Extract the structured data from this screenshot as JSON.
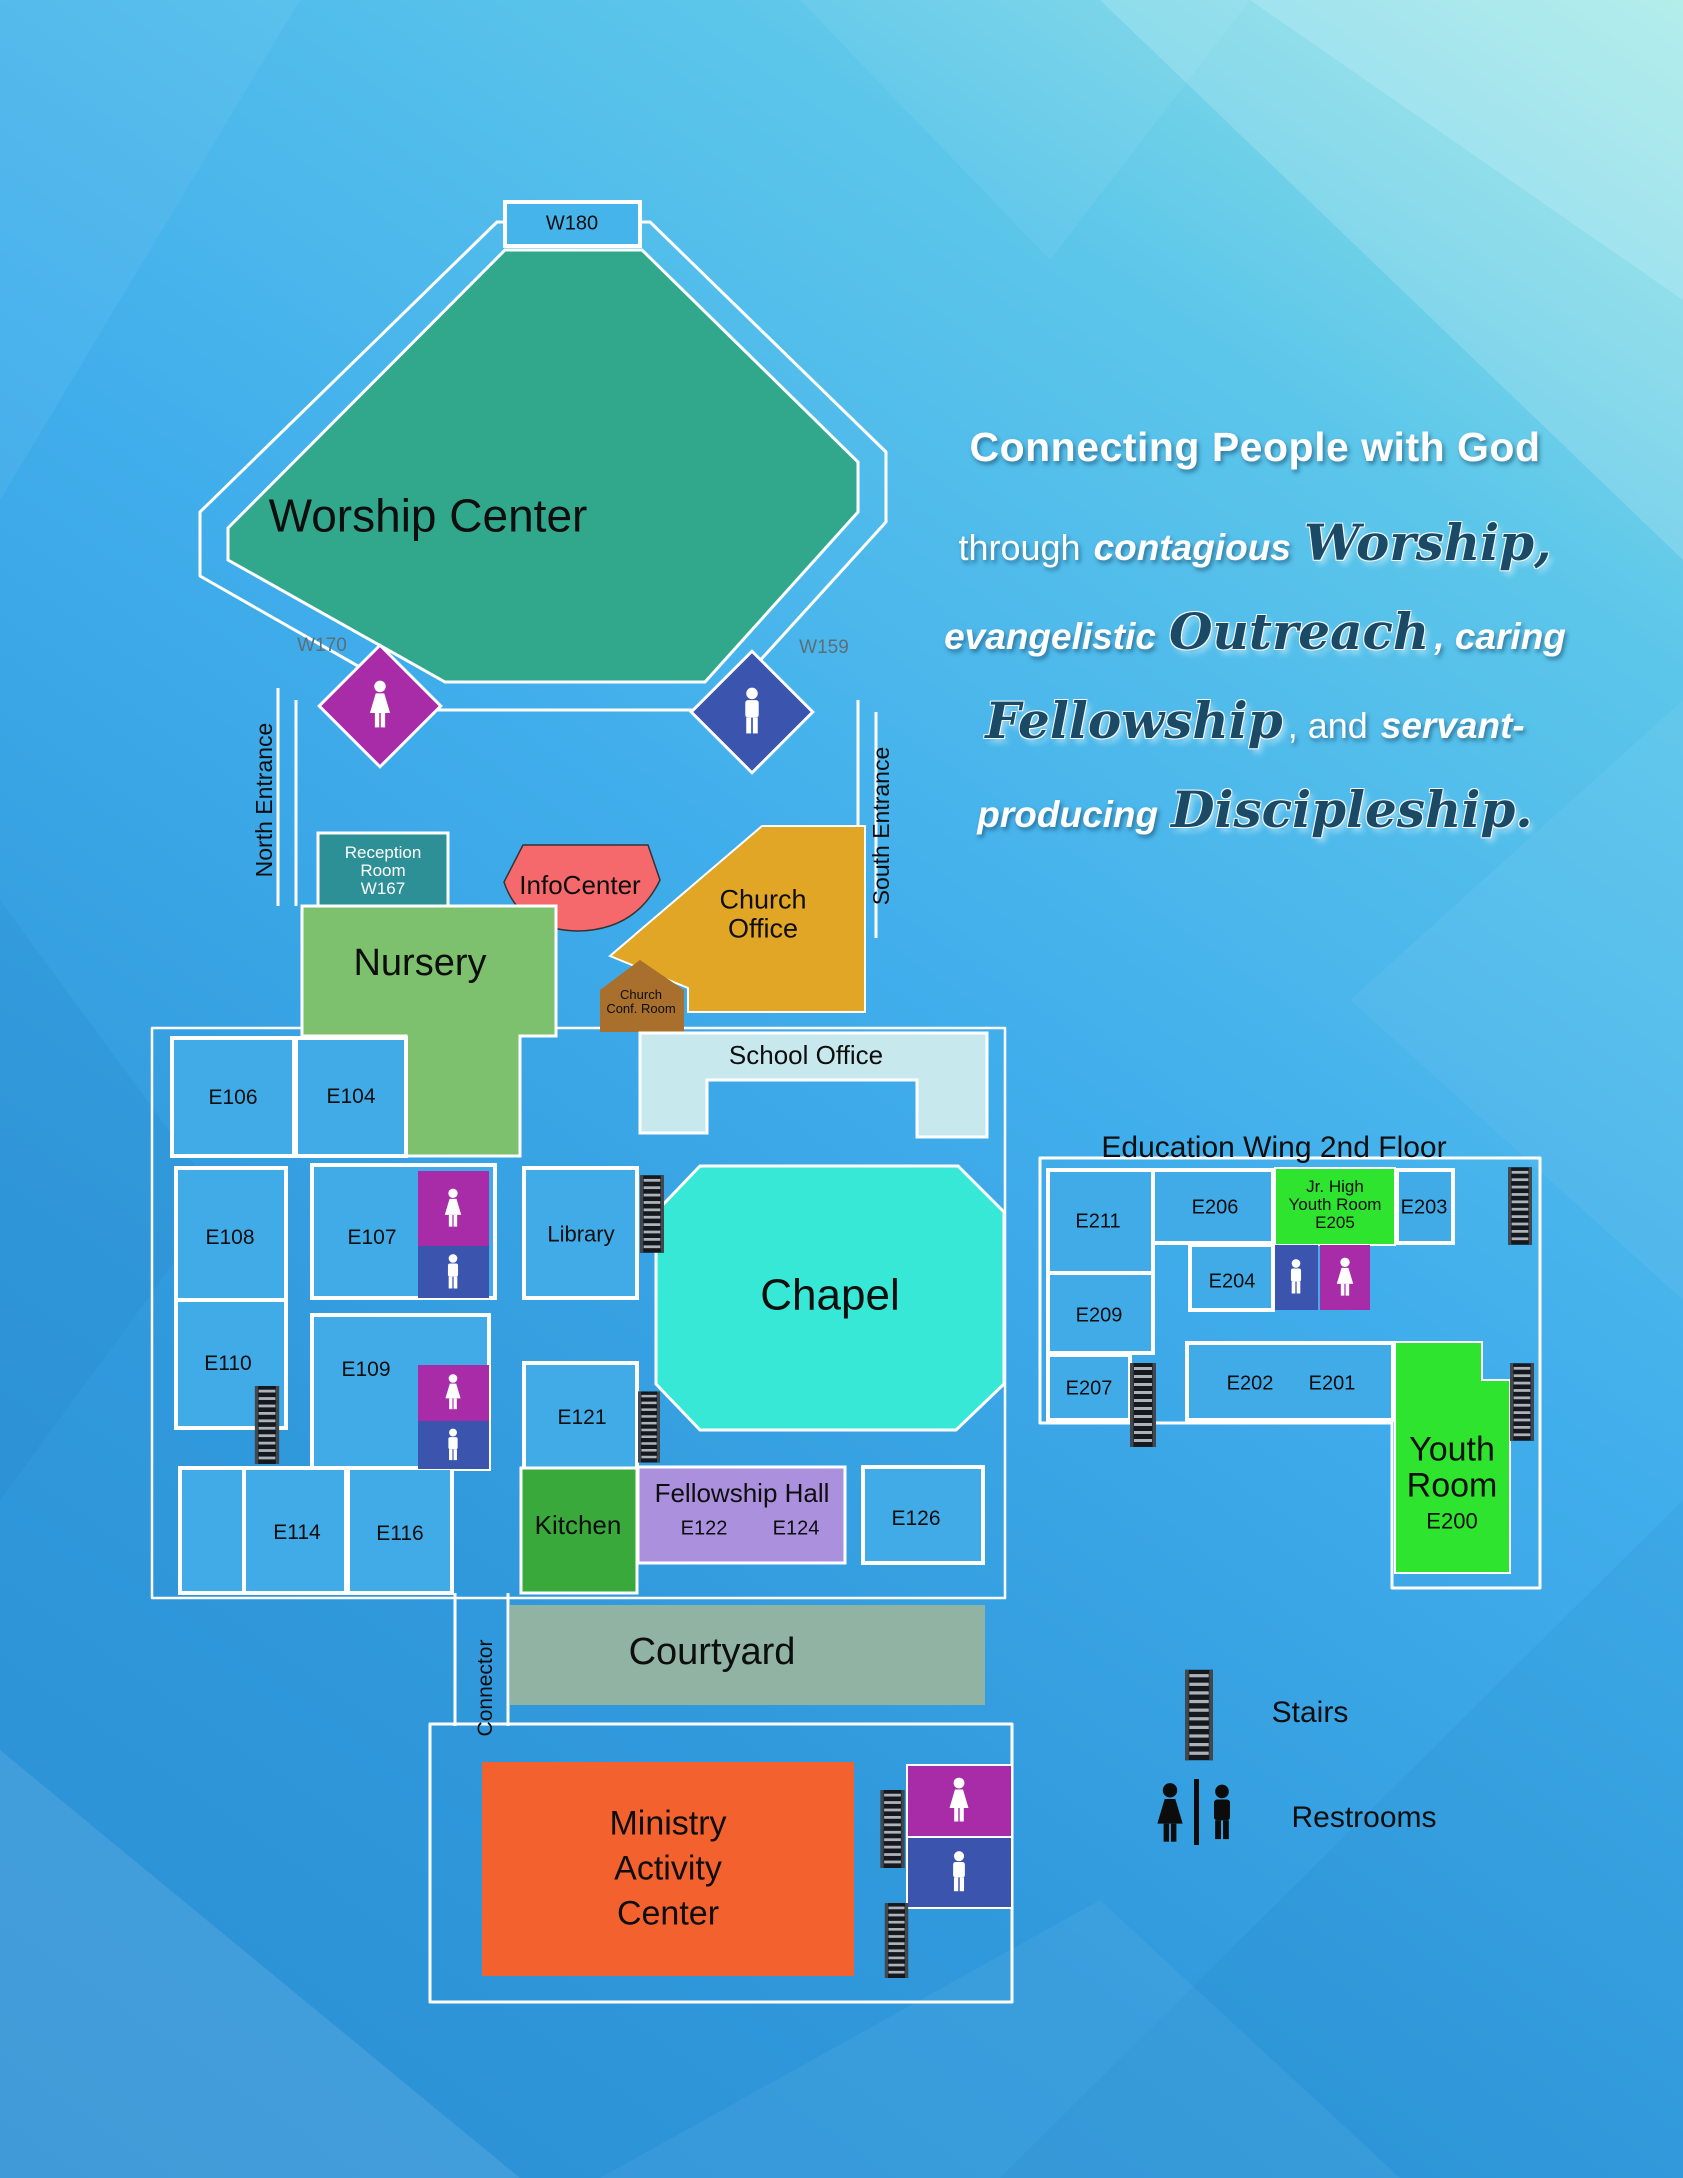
{
  "tagline": {
    "line1": "Connecting People with God",
    "line2": {
      "plain": "through",
      "bold": "contagious",
      "script": "Worship,"
    },
    "line3": {
      "bold": "evangelistic",
      "script": "Outreach",
      "bold2": ", caring"
    },
    "line4": {
      "script": "Fellowship",
      "plain": ", and",
      "bold": "servant-"
    },
    "line5": {
      "bold": "producing",
      "script": "Discipleship."
    }
  },
  "worship": {
    "name": "Worship Center",
    "w180": "W180",
    "w170": "W170",
    "w159": "W159"
  },
  "entrances": {
    "north": "North Entrance",
    "south": "South Entrance"
  },
  "first_floor": {
    "reception": [
      "Reception",
      "Room",
      "W167"
    ],
    "infocenter": "InfoCenter",
    "church_office": [
      "Church",
      "Office"
    ],
    "nursery": "Nursery",
    "church_conf": [
      "Church",
      "Conf. Room"
    ],
    "school_office": "School Office",
    "rooms": {
      "e106": "E106",
      "e104": "E104",
      "e108": "E108",
      "e110": "E110",
      "e107": "E107",
      "e109": "E109",
      "library": "Library",
      "e121": "E121",
      "e114": "E114",
      "e116": "E116",
      "e126": "E126"
    },
    "chapel": "Chapel",
    "kitchen": "Kitchen",
    "fellowship": {
      "name": "Fellowship Hall",
      "e122": "E122",
      "e124": "E124"
    },
    "connector": "Connector",
    "courtyard": "Courtyard",
    "mac": [
      "Ministry",
      "Activity",
      "Center"
    ]
  },
  "education_wing": {
    "title": "Education Wing 2nd Floor",
    "rooms": {
      "e211": "E211",
      "e206": "E206",
      "e203": "E203",
      "e204": "E204",
      "e209": "E209",
      "e207": "E207",
      "e202": "E202",
      "e201": "E201"
    },
    "jr_high": [
      "Jr. High",
      "Youth Room",
      "E205"
    ],
    "youth_room": {
      "line1": "Youth",
      "line2": "Room",
      "code": "E200"
    }
  },
  "legend": {
    "stairs": "Stairs",
    "restrooms": "Restrooms"
  },
  "colors": {
    "background_top_right": "#96e7e4",
    "background_bottom_left": "#2b8fd3",
    "worship_center": "#31a78c",
    "chapel": "#36e8d5",
    "nursery": "#7dc06d",
    "reception": "#2d9097",
    "infocenter": "#f5696c",
    "church_office": "#e2a627",
    "church_conf_room": "#a9702d",
    "school_office": "#c7e9ee",
    "kitchen": "#3aa93b",
    "fellowship_hall": "#aa90dd",
    "courtyard": "#90b3a3",
    "ministry_activity_center": "#f2612e",
    "youth_rooms": "#2ee42e",
    "room_blue": "#41abe8",
    "restroom_women": "#a82ba8",
    "restroom_men": "#3b55ae",
    "tagline_script": "#1b4a66"
  }
}
